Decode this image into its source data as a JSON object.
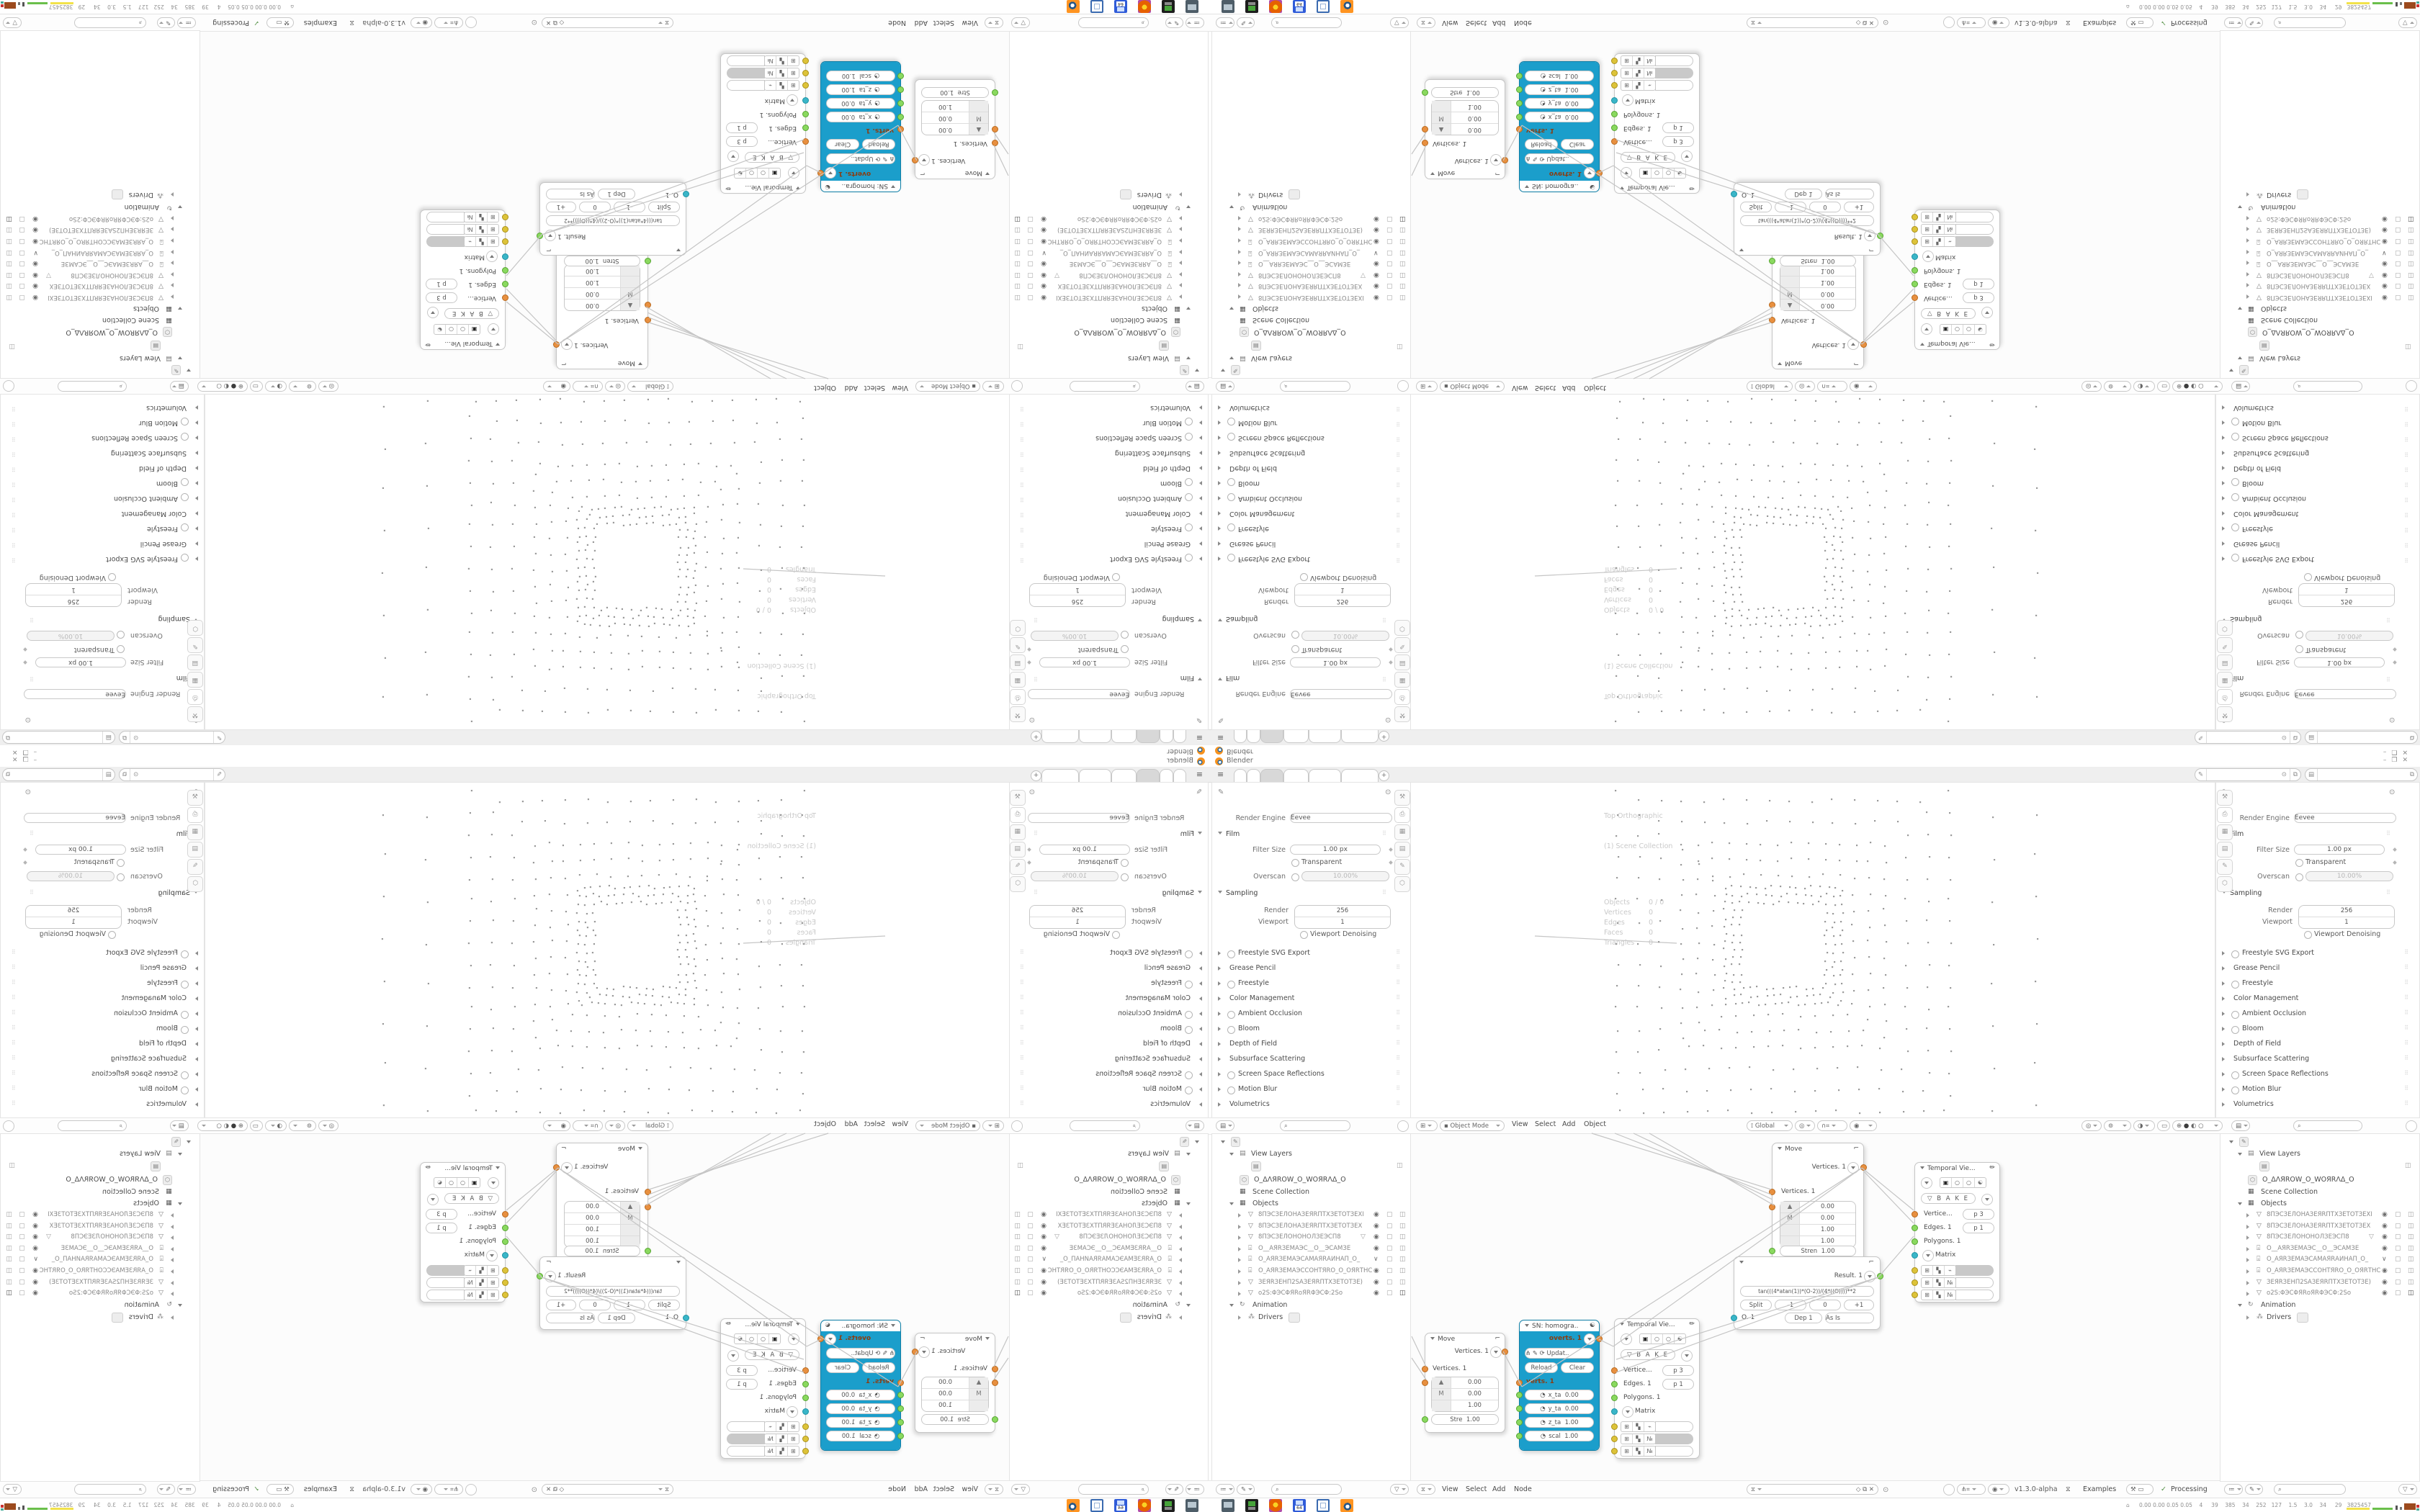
{
  "window": {
    "title": "Blender",
    "minimize": "–",
    "maximize": "❐",
    "close": "✕"
  },
  "tabbar": {
    "tab_count": 6,
    "active_tab": 3,
    "new_tab_label": "+"
  },
  "icons": {
    "hamburger": "≡",
    "pin": "⊙",
    "copy": "⧉",
    "search": "⌕",
    "funnel_v": "▽",
    "filter_list": "≔",
    "brush": "✎",
    "photo": "▤",
    "props_editor": "▤",
    "sv_editor": "⧖",
    "viewport_editor": "⊞",
    "mode_square": "▪",
    "orientation": "⟟",
    "magnet": "∩",
    "snap_grid": "⌗",
    "prop_edit": "◉",
    "gizmo": "◎",
    "overlays": "⊚",
    "xray": "◑",
    "frame_sel": "▭",
    "shade_wire": "⊕",
    "shade_solid": "●",
    "shade_material": "◐",
    "shade_render": "○",
    "mesh": "▽",
    "camera": "⌻",
    "collection": "▦",
    "animation": "↻",
    "drivers": "⁂",
    "eye": "◉",
    "monitor": "▢",
    "cam_toggle": "◫",
    "check": "✓",
    "flask_pill": "⚒",
    "screen_pill": "▭",
    "node_update": "⟳",
    "yin": "☯",
    "pencil": "✏",
    "bake_tri": "▽",
    "plug": "◔",
    "cube": "▣",
    "move_corner": "⌐",
    "wrench": "⌐",
    "person": "◈",
    "world": "⬡",
    "tool": "⚒",
    "printer": "⎙",
    "image": "▦",
    "tree_shield": "◇",
    "unlink": "✕",
    "curve_fork": "⋔",
    "hash": "⌗"
  },
  "properties": {
    "render_engine_label": "Render Engine",
    "render_engine_value": "Eevee",
    "film": {
      "label": "Film",
      "filter_size_label": "Filter Size",
      "filter_size_value": "1.00 px",
      "transparent_label": "Transparent",
      "overscan_label": "Overscan",
      "overscan_value": "10.00%"
    },
    "sampling": {
      "label": "Sampling",
      "render_label": "Render",
      "render_value": "256",
      "viewport_label": "Viewport",
      "viewport_value": "1",
      "denoise_label": "Viewport Denoising"
    },
    "sections": [
      {
        "label": "Freestyle SVG Export",
        "toggle": true
      },
      {
        "label": "Grease Pencil",
        "toggle": false
      },
      {
        "label": "Freestyle",
        "toggle": true
      },
      {
        "label": "Color Management",
        "toggle": false
      },
      {
        "label": "Ambient Occlusion",
        "toggle": true
      },
      {
        "label": "Bloom",
        "toggle": true
      },
      {
        "label": "Depth of Field",
        "toggle": false
      },
      {
        "label": "Subsurface Scattering",
        "toggle": false
      },
      {
        "label": "Screen Space Reflections",
        "toggle": true
      },
      {
        "label": "Motion Blur",
        "toggle": true
      },
      {
        "label": "Volumetrics",
        "toggle": false
      }
    ]
  },
  "viewport": {
    "overlay_view": "Top Orthographic",
    "overlay_collection": "(1) Scene Collection",
    "stats": [
      {
        "k": "Objects",
        "v": "0 / 0"
      },
      {
        "k": "Vertices",
        "v": "0"
      },
      {
        "k": "Edges",
        "v": "0"
      },
      {
        "k": "Faces",
        "v": "0"
      },
      {
        "k": "Triangles",
        "v": "0"
      }
    ],
    "header": {
      "mode": "Object Mode",
      "menus": [
        "View",
        "Select",
        "Add",
        "Object"
      ],
      "orientation": "Global"
    }
  },
  "node_editor": {
    "menus": [
      "View",
      "Select",
      "Add",
      "Node"
    ],
    "version": "v1.3.0-alpha",
    "examples_label": "Examples",
    "processing_label": "Processing"
  },
  "outliner": {
    "view_layers_label": "View Layers",
    "workspace_object": "O_ΔΛЯROW_O_WOЯRΛΔ_O",
    "scene_collection_label": "Scene Collection",
    "objects_label": "Objects",
    "objects": [
      {
        "type": "mesh",
        "name": "8ПЭСЗЕЛОНАЗЕЯRПТХЗЕТОТЗЕХI",
        "eye": "on"
      },
      {
        "type": "mesh",
        "name": "8ПЭСЗЕЛОНАЗЕЯRПТХЗЕТОТЗЕХ",
        "eye": "on"
      },
      {
        "type": "mesh",
        "name": "8ПЭСЗЕЛОНОНОЛЗЕЭСП8",
        "extra_mesh": true,
        "eye": "on"
      },
      {
        "type": "camera",
        "name": "O__АЯRЗЕМАЭС__O__ЭСАМЗЕ",
        "eye": "on"
      },
      {
        "type": "camera",
        "name": "O_АЯRЗЕМАЭСАМАЯRАИНАП_O_",
        "eye": "chev"
      },
      {
        "type": "camera",
        "name": "O_АЯRЗЕМАЭССОНТЯRО_O_ОЯRТНС",
        "eye": "on"
      },
      {
        "type": "mesh",
        "name": "ЗЕЯRЗЕНП2SАЗЕЯRПТХЗЕТОТЗЕ)",
        "eye": "on"
      },
      {
        "type": "mesh",
        "name": "ο2S:ΦЭСΦЯRοЯRΦЭСΦ:2Sο",
        "eye": "on",
        "cam_filled": true
      }
    ],
    "animation_label": "Animation",
    "drivers_label": "Drivers"
  },
  "nodes": {
    "move1": {
      "title": "Move",
      "out": "Vertices. 1",
      "in": "Vertices. 1",
      "rows": [
        [
          "",
          "0.00"
        ],
        [
          "M",
          "0.00"
        ],
        [
          "",
          "1.00"
        ]
      ],
      "stre_label": "Stre",
      "stre_value": "1.00"
    },
    "move2": {
      "title": "Move",
      "out": "Vertices. 1",
      "in": "Vertices. 1",
      "rows": [
        [
          "",
          "0.00"
        ],
        [
          "M",
          "0.00"
        ],
        [
          "",
          "1.00"
        ],
        [
          "",
          "1.00"
        ]
      ],
      "stre_label": "Stren",
      "stre_value": "1.00"
    },
    "sn": {
      "title": "SN: homogra..",
      "out": "overts. 1",
      "in": "verts. 1",
      "update_label": "Updat..",
      "reload_label": "Reload",
      "clear_label": "Clear",
      "fields": [
        [
          "x_ta",
          "0.00"
        ],
        [
          "y_ta",
          "0.00"
        ],
        [
          "z_ta",
          "1.00"
        ],
        [
          "scal",
          "1.00"
        ]
      ]
    },
    "temporal": {
      "title": "Temporal Vie...",
      "bake_label": "B A K E",
      "vertices_label": "Vertice...",
      "vertices_value": "p  3",
      "edges_label": "Edges. 1",
      "edges_value": "p  1",
      "polygons_label": "Polygons. 1",
      "matrix_label": "Matrix"
    },
    "formula": {
      "result_label": "Result. 1",
      "expression": "tan(((4*atan(1))*(O-2))/(4*((O))))**2",
      "pills": [
        "Split",
        "-1",
        "0",
        "+1"
      ],
      "out_label": "O. 1",
      "dep_label": "Dep 1",
      "mode_label": "As Is"
    }
  },
  "taskbar": {
    "stats_text": "0.00 0.00 0.05 0.05    4     39    385    34    252   127    1.5    3.0    34     29   3825457",
    "icons": [
      "screenshot-tool",
      "package-manager",
      "firefox",
      "save-64",
      "frame-tool",
      "blender"
    ]
  }
}
